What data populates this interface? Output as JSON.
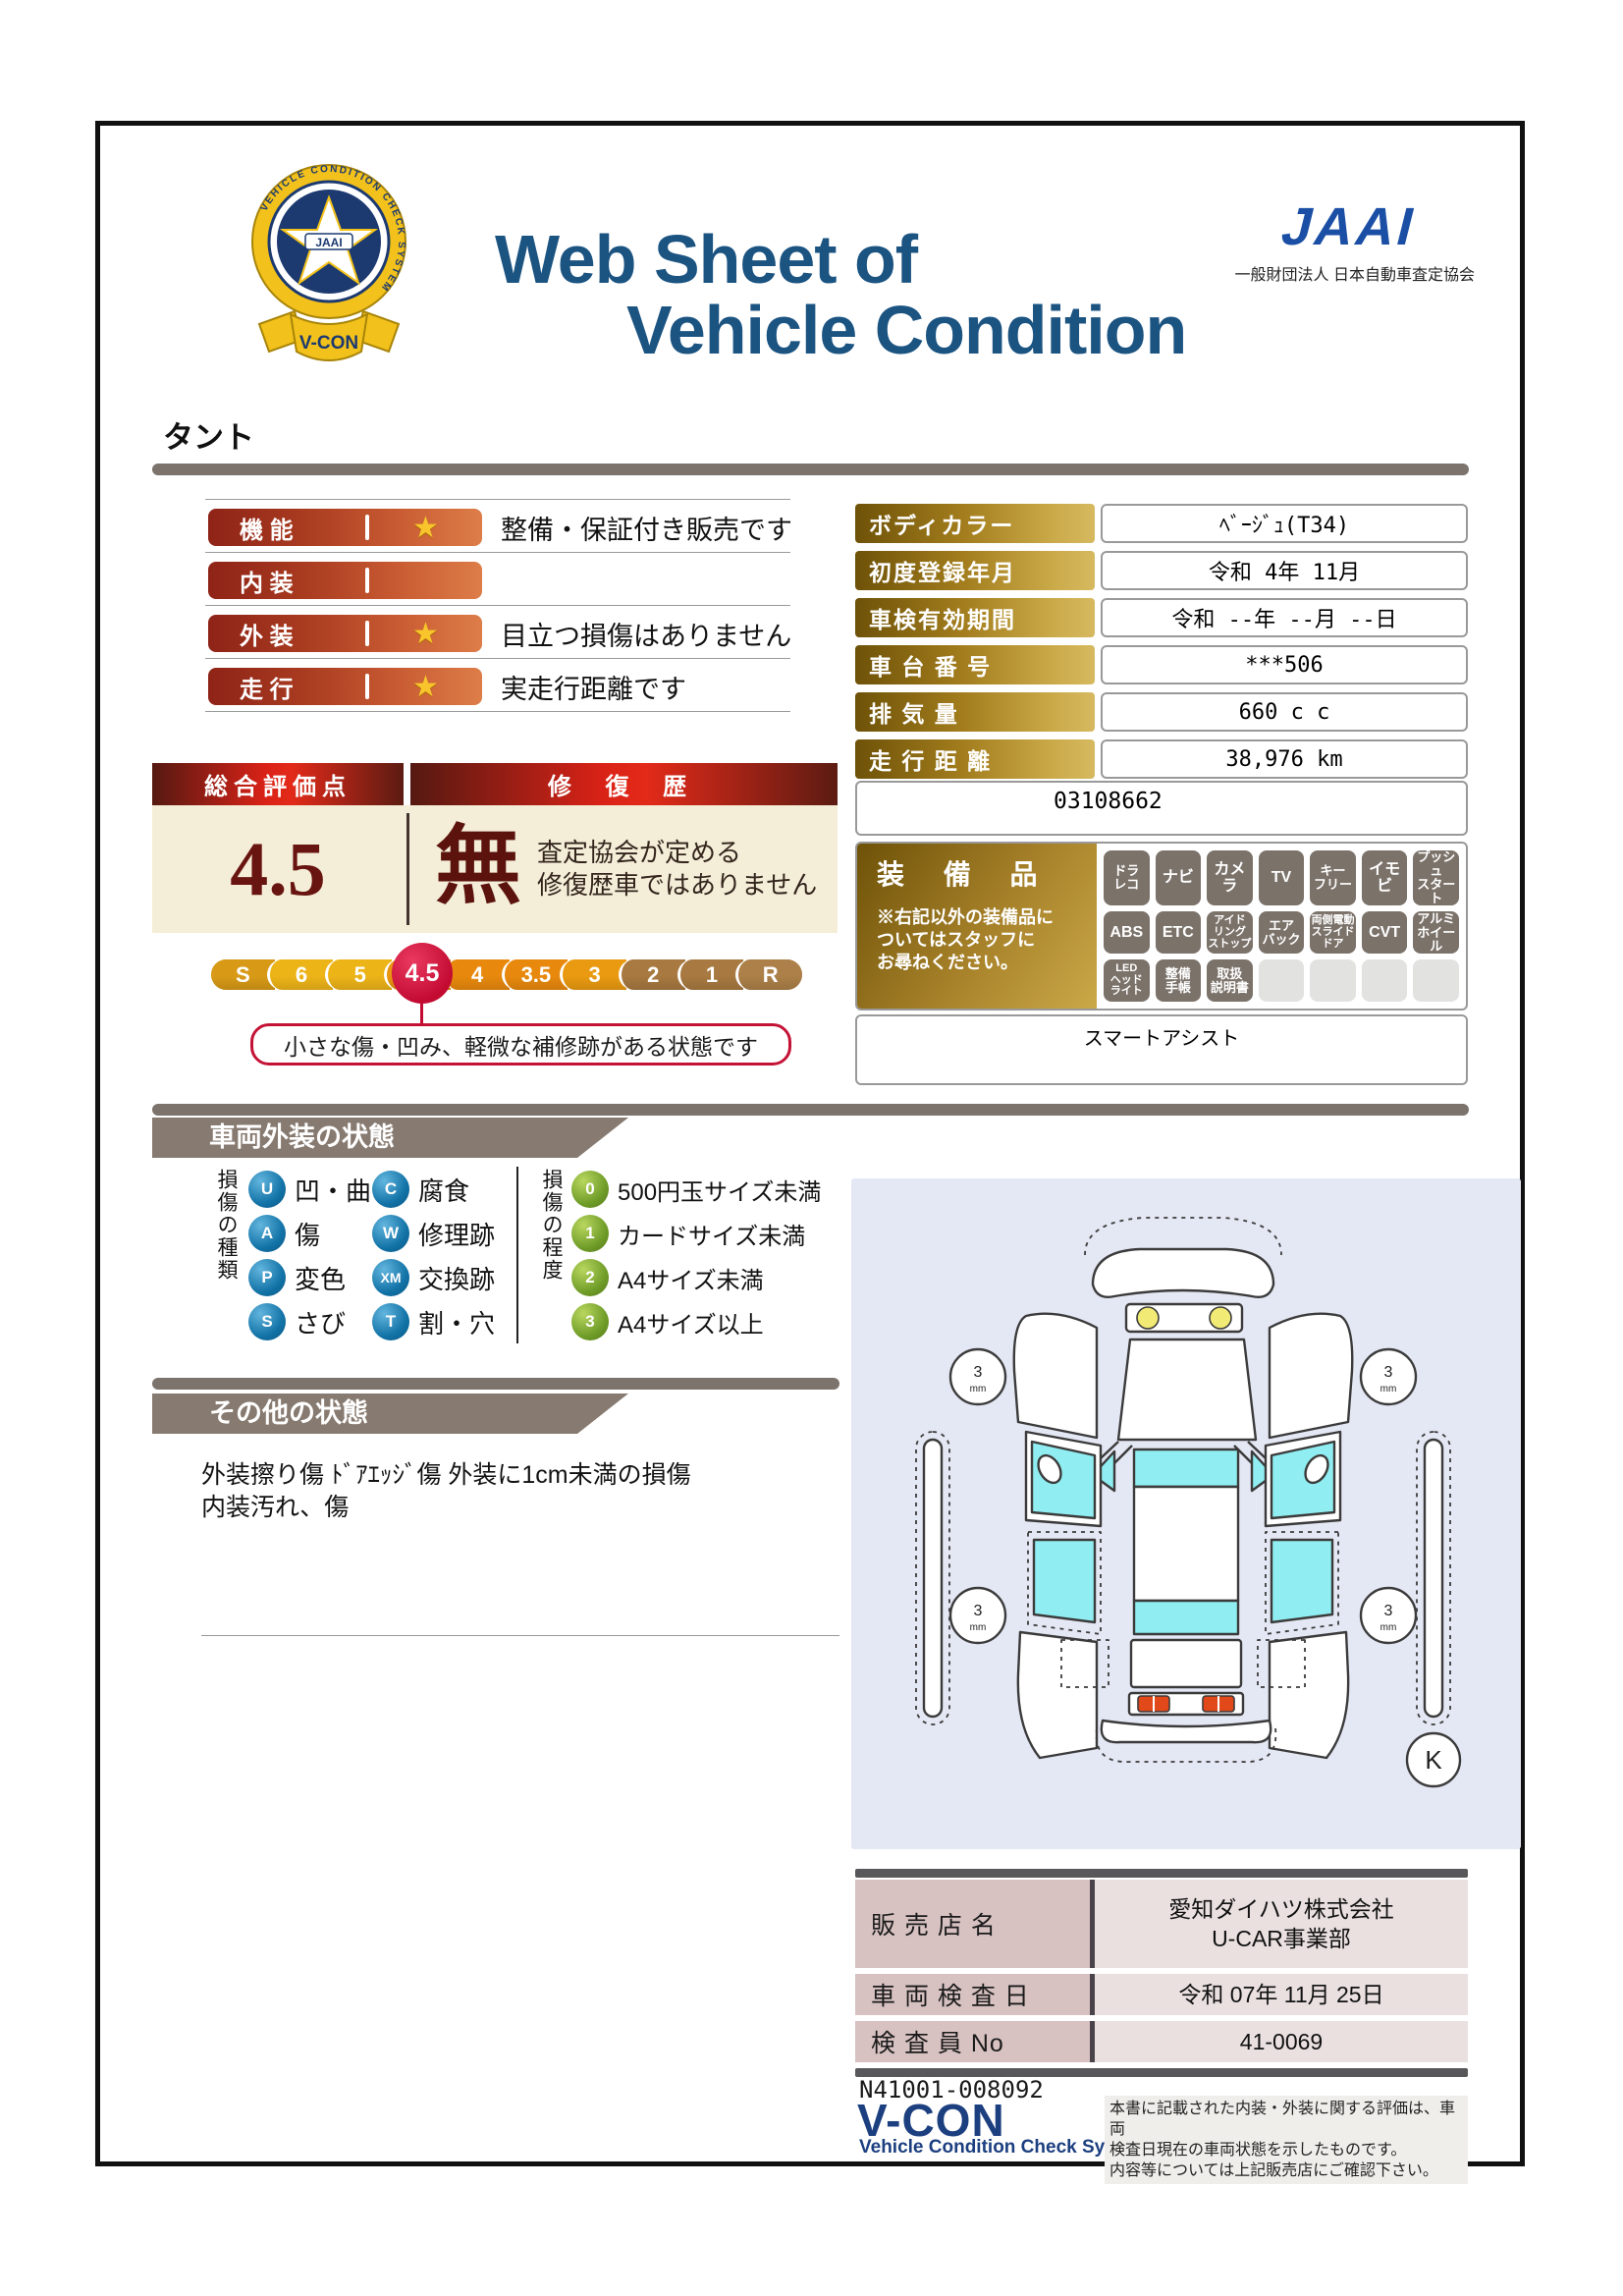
{
  "page": {
    "vehicle_name": "タント"
  },
  "header": {
    "title_line1": "Web Sheet of",
    "title_line2": "Vehicle Condition",
    "jaai_logo": "JAAI",
    "jaai_org": "一般財団法人 日本自動車査定協会",
    "emblem_ring_text": "VEHICLE CONDITION CHECK SYSTEM",
    "emblem_center": "JAAI",
    "emblem_ribbon": "V-CON"
  },
  "ratings": [
    {
      "label": "機 能",
      "star": true,
      "desc": "整備・保証付き販売です"
    },
    {
      "label": "内 装",
      "star": false,
      "desc": ""
    },
    {
      "label": "外 装",
      "star": true,
      "desc": "目立つ損傷はありません"
    },
    {
      "label": "走 行",
      "star": true,
      "desc": "実走行距離です"
    }
  ],
  "overall": {
    "score_header": "総合評価点",
    "repair_header": "修 復 歴",
    "score": "4.5",
    "repair_value": "無",
    "repair_note": "査定協会が定める\n修復歴車ではありません",
    "scale": [
      {
        "label": "S",
        "color": "#d89a16"
      },
      {
        "label": "6",
        "color": "#edb418"
      },
      {
        "label": "5",
        "color": "#edb418"
      },
      {
        "label": "4.5",
        "color": "#e8960f",
        "current": true
      },
      {
        "label": "4",
        "color": "#e8890d"
      },
      {
        "label": "3.5",
        "color": "#e8890d"
      },
      {
        "label": "3",
        "color": "#ea9a10"
      },
      {
        "label": "2",
        "color": "#a87940"
      },
      {
        "label": "1",
        "color": "#a87940"
      },
      {
        "label": "R",
        "color": "#ac8048"
      }
    ],
    "scale_note": "小さな傷・凹み、軽微な補修跡がある状態です",
    "balloon_color": "#c60e35"
  },
  "spec_table": {
    "rows": [
      {
        "label": "ボディカラー",
        "value": "ﾍﾞｰｼﾞｭ(T34)"
      },
      {
        "label": "初度登録年月",
        "value": "令和 4年 11月"
      },
      {
        "label": "車検有効期間",
        "value": "令和 --年 --月 --日"
      },
      {
        "label": "車 台 番 号",
        "value": "***506"
      },
      {
        "label": "排  気  量",
        "value": "660 c c"
      },
      {
        "label": "走 行 距 離",
        "value": "38,976 km"
      }
    ],
    "extra_number": "03108662"
  },
  "equipment": {
    "title": "装 備 品",
    "note": "※右記以外の装備品に\nついてはスタッフに\nお尋ねください。",
    "badges": [
      {
        "label": "ドラ\nレコ",
        "active": true
      },
      {
        "label": "ナビ",
        "active": true
      },
      {
        "label": "カメラ",
        "active": true
      },
      {
        "label": "TV",
        "active": true
      },
      {
        "label": "キー\nフリー",
        "active": true
      },
      {
        "label": "イモビ",
        "active": true
      },
      {
        "label": "プッシュ\nスタート",
        "active": true
      },
      {
        "label": "ABS",
        "active": true
      },
      {
        "label": "ETC",
        "active": true
      },
      {
        "label": "アイド\nリング\nストップ",
        "active": true
      },
      {
        "label": "エア\nバック",
        "active": true
      },
      {
        "label": "両側電動\nスライド\nドア",
        "active": true
      },
      {
        "label": "CVT",
        "active": true
      },
      {
        "label": "アルミ\nホイール",
        "active": true
      },
      {
        "label": "LED\nヘッド\nライト",
        "active": true
      },
      {
        "label": "整備\n手帳",
        "active": true
      },
      {
        "label": "取扱\n説明書",
        "active": true
      },
      {
        "label": "",
        "active": false
      },
      {
        "label": "",
        "active": false
      },
      {
        "label": "",
        "active": false
      },
      {
        "label": "",
        "active": false
      }
    ],
    "footer_note": "スマートアシスト"
  },
  "exterior": {
    "section_title": "車両外装の状態",
    "kind_header": "損傷の種類",
    "kinds": [
      {
        "code": "U",
        "label": "凹・曲"
      },
      {
        "code": "C",
        "label": "腐食"
      },
      {
        "code": "A",
        "label": "傷"
      },
      {
        "code": "W",
        "label": "修理跡"
      },
      {
        "code": "P",
        "label": "変色"
      },
      {
        "code": "XM",
        "label": "交換跡"
      },
      {
        "code": "S",
        "label": "さび"
      },
      {
        "code": "T",
        "label": "割・穴"
      }
    ],
    "degree_header": "損傷の程度",
    "degrees": [
      {
        "code": "0",
        "label": "500円玉サイズ未満"
      },
      {
        "code": "1",
        "label": "カードサイズ未満"
      },
      {
        "code": "2",
        "label": "A4サイズ未満"
      },
      {
        "code": "3",
        "label": "A4サイズ以上"
      }
    ],
    "diagram": {
      "tread_value": "3",
      "tread_unit": "mm",
      "corner_mark": "K"
    }
  },
  "other": {
    "section_title": "その他の状態",
    "text": "外装擦り傷 ﾄﾞｱｴｯｼﾞ傷 外装に1cm未満の損傷\n内装汚れ、傷"
  },
  "dealer": {
    "rows": [
      {
        "label": "販 売 店 名",
        "value": "愛知ダイハツ株式会社\nU-CAR事業部"
      },
      {
        "label": "車 両 検 査 日",
        "value": "令和 07年 11月 25日"
      },
      {
        "label": "検 査 員 No",
        "value": "41-0069"
      }
    ]
  },
  "footer": {
    "doc_number": "N41001-008092",
    "vcon_logo": "V-CON",
    "vcon_sub": "Vehicle Condition Check System",
    "disclaimer": "本書に記載された内装・外装に関する評価は、車両\n検査日現在の車両状態を示したものです。\n内容等については上記販売店にご確認下さい。"
  }
}
